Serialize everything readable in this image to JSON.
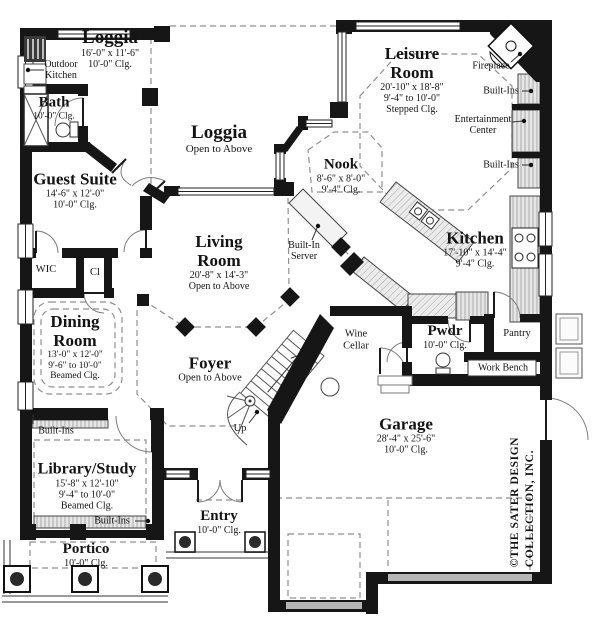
{
  "colors": {
    "wall": "#161616",
    "dash": "#8f8f8f",
    "counter_fill": "#ececec",
    "garage_door": "#b5b5b5"
  },
  "rooms": {
    "loggia_top": {
      "name": "Loggia",
      "dims": "16'-0\" x 11'-6\"",
      "clg": "10'-0\" Clg."
    },
    "loggia_center": {
      "name": "Loggia",
      "note": "Open to Above"
    },
    "outdoor_kitchen": {
      "line1": "Outdoor",
      "line2": "Kitchen"
    },
    "bath": {
      "name": "Bath",
      "clg": "10'-0\" Clg."
    },
    "guest_suite": {
      "name": "Guest Suite",
      "dims": "14'-6\" x 12'-0\"",
      "clg": "10'-0\" Clg."
    },
    "wic": {
      "name": "WIC"
    },
    "cl": {
      "name": "Cl"
    },
    "nook": {
      "name": "Nook",
      "dims": "8'-6\" x 8'-0\"",
      "clg": "9'-4\" Clg."
    },
    "leisure_room": {
      "name": "Leisure Room",
      "dims": "20'-10\" x 18'-8\"",
      "range": "9'-4\" to 10'-0\"",
      "clg": "Stepped Clg."
    },
    "living_room": {
      "name": "Living Room",
      "dims": "20'-8\" x 14'-3\"",
      "note": "Open to Above"
    },
    "kitchen": {
      "name": "Kitchen",
      "dims": "17'-10\" x 14'-4\"",
      "clg": "9'-4\" Clg."
    },
    "dining_room": {
      "name": "Dining Room",
      "dims": "13'-0\" x 12'-0\"",
      "range": "9'-6\" to 10'-0\"",
      "clg": "Beamed Clg."
    },
    "foyer": {
      "name": "Foyer",
      "note": "Open to Above"
    },
    "wine_cellar": {
      "name": "Wine Cellar"
    },
    "pwdr": {
      "name": "Pwdr",
      "clg": "10'-0\" Clg."
    },
    "pantry": {
      "name": "Pantry"
    },
    "garage": {
      "name": "Garage",
      "dims": "28'-4\" x 25'-6\"",
      "clg": "10'-0\" Clg."
    },
    "library_study": {
      "name": "Library/Study",
      "dims": "15'-8\" x 12'-10\"",
      "range": "9'-4\" to 10'-0\"",
      "clg": "Beamed Clg."
    },
    "entry": {
      "name": "Entry",
      "clg": "10'-0\" Clg."
    },
    "portico": {
      "name": "Portico",
      "clg": "10'-0\" Clg."
    }
  },
  "annotations": {
    "fireplace": "Fireplace",
    "built_ins_right_upper": "Built-Ins",
    "built_ins_right_lower": "Built-Ins",
    "entertainment_center": {
      "line1": "Entertainment",
      "line2": "Center"
    },
    "built_in_server": {
      "line1": "Built-In",
      "line2": "Server"
    },
    "built_ins_library_top": "Built-Ins",
    "built_ins_library_bottom": "Built-Ins",
    "work_bench": "Work Bench",
    "up": "Up"
  },
  "copyright": {
    "line1": "©THE SATER DESIGN",
    "line2": "COLLECTION, INC."
  }
}
